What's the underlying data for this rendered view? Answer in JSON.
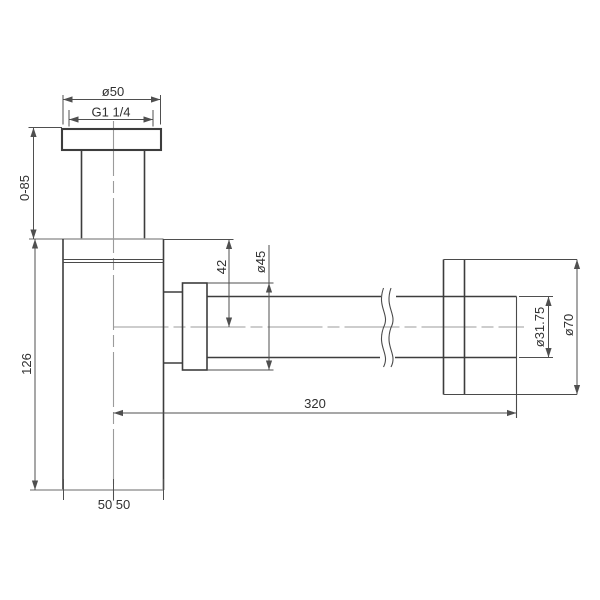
{
  "drawing": {
    "kind": "technical-drawing",
    "subject": "bottle-trap-siphon-side-view",
    "units": "mm",
    "colors": {
      "background": "#ffffff",
      "outline": "#3d3d3d",
      "centerline": "#9b9b9b",
      "dimension": "#4f4f4f"
    },
    "dimensions": {
      "top_flange_diameter": {
        "label": "ø50",
        "value": 50
      },
      "inlet_thread": {
        "label": "G1 1/4"
      },
      "inlet_height_range": {
        "label": "0-85",
        "min": 0,
        "max": 85
      },
      "body_height": {
        "label": "126",
        "value": 126
      },
      "outlet_drop": {
        "label": "42",
        "value": 42
      },
      "nut_diameter": {
        "label": "ø45",
        "value": 45
      },
      "outlet_pipe_diameter": {
        "label": "ø31.75",
        "value": 31.75
      },
      "wall_flange_diameter": {
        "label": "ø70",
        "value": 70
      },
      "outlet_length": {
        "label": "320",
        "value": 320
      },
      "base_widths": {
        "label": "50 50",
        "values": [
          50,
          50
        ]
      }
    }
  }
}
